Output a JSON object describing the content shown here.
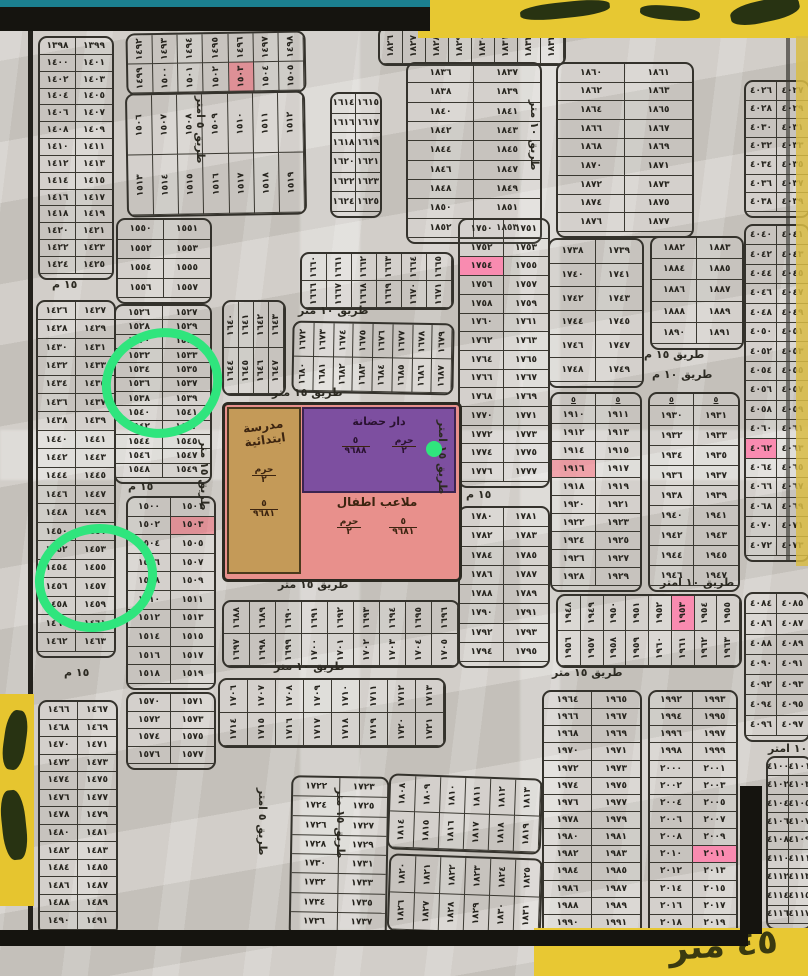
{
  "map_title": "hand-drawn cadastral plot map",
  "arabic_digits": "٠١٢٣٤٥٦٧٨٩",
  "cap_label": "٥",
  "colors": {
    "paper": "#cdc9c3",
    "ink": "#26241e",
    "teal_band": "#1b7f8f",
    "black_band": "#15140f",
    "tape_yellow": "#e7c832",
    "highlight_pink": "#f98bb0",
    "highlight_red": "#ff4b5f",
    "school_tan": "#c49a58",
    "nursery_purple": "#7d4fa0",
    "playground_pink": "#e8908c",
    "circle_green": "#2fe57d"
  },
  "facility": {
    "school": {
      "line1": "مدرسة",
      "line2": "ابتدائية",
      "frac1_top": "حرم",
      "frac1_bot": "٢",
      "frac2_top": "٥",
      "frac2_bot": "٩٦٨١"
    },
    "nursery": {
      "name": "دار حضانة",
      "frac1_top": "حرم",
      "frac1_bot": "٢",
      "frac2_top": "٥",
      "frac2_bot": "٩٦٨٨"
    },
    "playground": {
      "name": "ملاعب اطفال",
      "frac1_top": "٥",
      "frac1_bot": "٩٦٨١",
      "frac2_top": "حرم",
      "frac2_bot": "٢"
    }
  },
  "bottom_tape_text": "٤٥ متر",
  "highlights": {
    "pink": [
      1754,
      1953,
      2011,
      4062
    ],
    "red": [
      1503,
      1916
    ]
  },
  "green_marks": {
    "circles": [
      {
        "cx": 162,
        "cy": 383,
        "rx": 56,
        "ry": 50
      },
      {
        "cx": 96,
        "cy": 578,
        "rx": 57,
        "ry": 49
      }
    ],
    "dot": {
      "cx": 434,
      "cy": 449,
      "r": 8
    }
  },
  "streets": [
    {
      "text": "طريق ١٥ متر",
      "x": 272,
      "y": 386,
      "rot": 0
    },
    {
      "text": "طريق ١٠ متر",
      "x": 298,
      "y": 304,
      "rot": 0
    },
    {
      "text": "طريق ١٥ متر",
      "x": 278,
      "y": 578,
      "rot": 0
    },
    {
      "text": "طريق ١٠ متر",
      "x": 274,
      "y": 660,
      "rot": 0
    },
    {
      "text": "طريق ١٥ متر",
      "x": 552,
      "y": 666,
      "rot": 0
    },
    {
      "text": "طريق ١٥ م",
      "x": 644,
      "y": 348,
      "rot": 0
    },
    {
      "text": "طريق ١٠ م",
      "x": 652,
      "y": 368,
      "rot": 0
    },
    {
      "text": "طريق ١٠ امتر",
      "x": 660,
      "y": 576,
      "rot": 0
    },
    {
      "text": "١٥ م",
      "x": 52,
      "y": 278,
      "rot": 0
    },
    {
      "text": "١٥ م",
      "x": 64,
      "y": 666,
      "rot": 0
    },
    {
      "text": "١٥ م",
      "x": 128,
      "y": 480,
      "rot": 0
    },
    {
      "text": "١٥ م",
      "x": 466,
      "y": 488,
      "rot": 0
    },
    {
      "text": "١٠ امتر",
      "x": 768,
      "y": 742,
      "rot": 0
    },
    {
      "text": "طريق ٥ امتر",
      "x": 194,
      "y": 96,
      "rot": 90
    },
    {
      "text": "طريق ١٥ متر",
      "x": 198,
      "y": 440,
      "rot": 90
    },
    {
      "text": "طريق ١٥ امتر",
      "x": 436,
      "y": 420,
      "rot": 90
    },
    {
      "text": "طريق ٥ امتر",
      "x": 256,
      "y": 788,
      "rot": 90
    },
    {
      "text": "طريق ١٥ متر",
      "x": 334,
      "y": 788,
      "rot": 90
    },
    {
      "text": "طريق ١٠ متر",
      "x": 528,
      "y": 100,
      "rot": 90
    }
  ],
  "blocks": [
    {
      "x": 38,
      "y": 36,
      "w": 72,
      "h": 240,
      "o": "v",
      "s": 1398,
      "e": 1425
    },
    {
      "x": 36,
      "y": 300,
      "w": 76,
      "h": 354,
      "o": "v",
      "s": 1426,
      "e": 1463
    },
    {
      "x": 38,
      "y": 700,
      "w": 76,
      "h": 232,
      "o": "v",
      "s": 1466,
      "e": 1491
    },
    {
      "x": 116,
      "y": 218,
      "w": 92,
      "h": 82,
      "o": "v",
      "s": 1550,
      "e": 1557
    },
    {
      "x": 114,
      "y": 304,
      "w": 94,
      "h": 176,
      "o": "v",
      "s": 1526,
      "e": 1549
    },
    {
      "x": 126,
      "y": 496,
      "w": 86,
      "h": 190,
      "o": "v",
      "s": 1500,
      "e": 1519
    },
    {
      "x": 126,
      "y": 692,
      "w": 86,
      "h": 74,
      "o": "v",
      "s": 1570,
      "e": 1577
    },
    {
      "x": 126,
      "y": 32,
      "w": 176,
      "h": 58,
      "o": "h",
      "s": 1492,
      "e": 1505,
      "r": -1
    },
    {
      "x": 126,
      "y": 92,
      "w": 176,
      "h": 120,
      "o": "h",
      "s": 1506,
      "e": 1519,
      "r": -1
    },
    {
      "x": 330,
      "y": 92,
      "w": 48,
      "h": 122,
      "o": "v",
      "s": 1614,
      "e": 1625
    },
    {
      "x": 378,
      "y": 26,
      "w": 184,
      "h": 36,
      "o": "h1",
      "s": 1826,
      "e": 1833
    },
    {
      "x": 406,
      "y": 62,
      "w": 132,
      "h": 178,
      "o": "v",
      "s": 1836,
      "e": 1853
    },
    {
      "x": 556,
      "y": 62,
      "w": 134,
      "h": 172,
      "o": "v",
      "s": 1860,
      "e": 1877
    },
    {
      "x": 650,
      "y": 236,
      "w": 90,
      "h": 110,
      "o": "v",
      "s": 1882,
      "e": 1891
    },
    {
      "x": 458,
      "y": 218,
      "w": 88,
      "h": 266,
      "o": "v",
      "s": 1750,
      "e": 1777
    },
    {
      "x": 458,
      "y": 506,
      "w": 88,
      "h": 158,
      "o": "v",
      "s": 1780,
      "e": 1795
    },
    {
      "x": 222,
      "y": 300,
      "w": 60,
      "h": 92,
      "o": "h",
      "s": 1640,
      "e": 1647
    },
    {
      "x": 300,
      "y": 252,
      "w": 150,
      "h": 54,
      "o": "h",
      "s": 1660,
      "e": 1671
    },
    {
      "x": 292,
      "y": 322,
      "w": 158,
      "h": 68,
      "o": "h",
      "s": 1672,
      "e": 1687,
      "r": 1
    },
    {
      "x": 222,
      "y": 600,
      "w": 234,
      "h": 64,
      "o": "h",
      "s": 1688,
      "e": 1705
    },
    {
      "x": 218,
      "y": 678,
      "w": 224,
      "h": 66,
      "o": "h",
      "s": 1706,
      "e": 1721
    },
    {
      "x": 290,
      "y": 776,
      "w": 94,
      "h": 158,
      "o": "v",
      "s": 1722,
      "e": 1737,
      "r": 1
    },
    {
      "x": 388,
      "y": 776,
      "w": 150,
      "h": 72,
      "o": "h",
      "s": 1808,
      "e": 1819,
      "r": 2
    },
    {
      "x": 388,
      "y": 856,
      "w": 150,
      "h": 74,
      "o": "h",
      "s": 1820,
      "e": 1831,
      "r": 2
    },
    {
      "x": 548,
      "y": 238,
      "w": 92,
      "h": 146,
      "o": "v",
      "s": 1738,
      "e": 1749
    },
    {
      "x": 550,
      "y": 392,
      "w": 88,
      "h": 196,
      "o": "v",
      "s": 1910,
      "e": 1929,
      "cap": true
    },
    {
      "x": 648,
      "y": 392,
      "w": 88,
      "h": 196,
      "o": "v",
      "s": 1930,
      "e": 1947,
      "cap": true
    },
    {
      "x": 556,
      "y": 594,
      "w": 182,
      "h": 70,
      "o": "h",
      "s": 1948,
      "e": 1963
    },
    {
      "x": 542,
      "y": 690,
      "w": 96,
      "h": 244,
      "o": "v",
      "s": 1964,
      "e": 1991
    },
    {
      "x": 648,
      "y": 690,
      "w": 86,
      "h": 244,
      "o": "v",
      "s": 1992,
      "e": 2019
    },
    {
      "x": 744,
      "y": 80,
      "w": 62,
      "h": 134,
      "o": "v",
      "s": 4026,
      "e": 4039
    },
    {
      "x": 744,
      "y": 224,
      "w": 62,
      "h": 334,
      "o": "v",
      "s": 4040,
      "e": 4073
    },
    {
      "x": 744,
      "y": 592,
      "w": 62,
      "h": 146,
      "o": "v",
      "s": 4084,
      "e": 4097
    },
    {
      "x": 766,
      "y": 756,
      "w": 42,
      "h": 170,
      "o": "v",
      "s": 4100,
      "e": 4117
    }
  ]
}
